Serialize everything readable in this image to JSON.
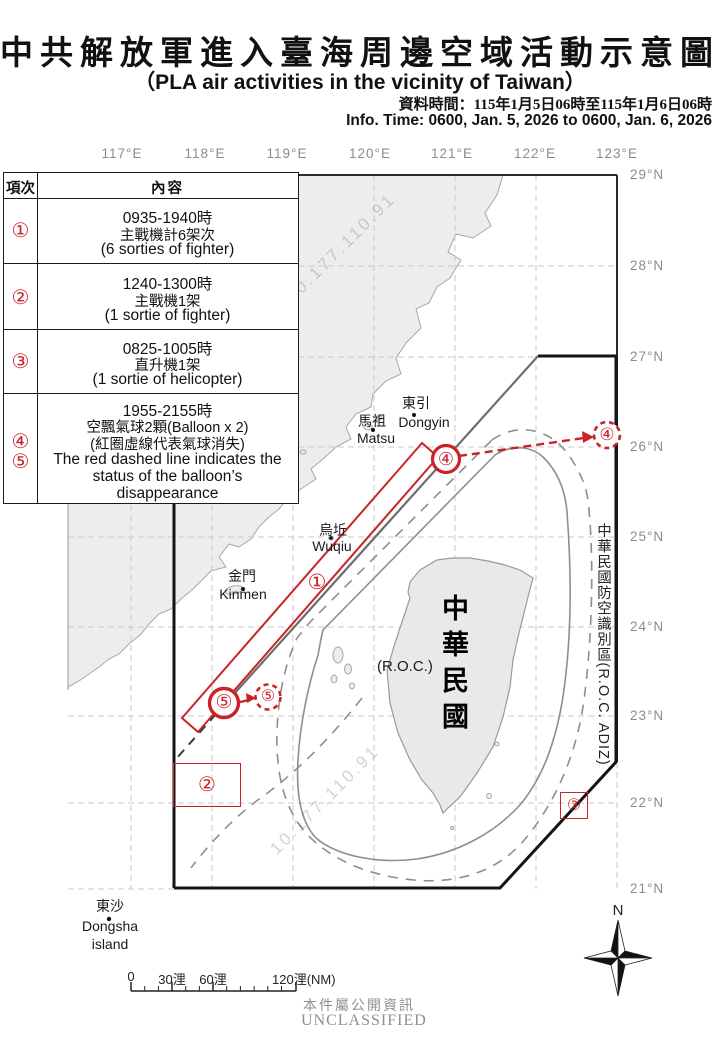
{
  "header": {
    "title_zh": "中共解放軍進入臺海周邊空域活動示意圖",
    "title_en": "（PLA air activities in the vicinity of Taiwan）",
    "info_time_zh": "資料時間：115年1月5日06時至115年1月6日06時",
    "info_time_en": "Info. Time: 0600, Jan. 5, 2026 to 0600, Jan. 6, 2026"
  },
  "table": {
    "col_item": "項次",
    "col_content": "內容",
    "rows": [
      {
        "num": "①",
        "lines": [
          "0935-1940時",
          "主戰機計6架次",
          "(6 sorties of fighter)"
        ]
      },
      {
        "num": "②",
        "lines": [
          "1240-1300時",
          "主戰機1架",
          "(1 sortie of fighter)"
        ]
      },
      {
        "num": "③",
        "lines": [
          "0825-1005時",
          "直升機1架",
          "(1 sortie of helicopter)"
        ]
      },
      {
        "num": "④",
        "num2": "⑤",
        "lines": [
          "1955-2155時",
          "空飄氣球2顆(Balloon x 2)",
          "(紅圈虛線代表氣球消失)",
          "The red dashed line indicates the",
          "status of the balloon’s",
          "disappearance"
        ]
      }
    ]
  },
  "map": {
    "lon_labels": [
      "117°E",
      "118°E",
      "119°E",
      "120°E",
      "121°E",
      "122°E",
      "123°E"
    ],
    "lat_labels": [
      "29°N",
      "28°N",
      "27°N",
      "26°N",
      "25°N",
      "24°N",
      "23°N",
      "22°N",
      "21°N"
    ],
    "places": {
      "dongyin_zh": "東引",
      "dongyin_en": "Dongyin",
      "matsu_zh": "馬祖",
      "matsu_en": "Matsu",
      "wuqiu_zh": "烏坵",
      "wuqiu_en": "Wuqiu",
      "kinmen_zh": "金門",
      "kinmen_en": "Kinmen",
      "dongsha_zh": "東沙",
      "dongsha_en1": "Dongsha",
      "dongsha_en2": "island"
    },
    "roc_zh": "中華民國",
    "roc_en": "(R.O.C.)",
    "adiz_label": "中華民國防空識別區(R.O.C. ADIZ)",
    "markers": {
      "m1": "①",
      "m2": "②",
      "m3": "③",
      "m4": "④",
      "m5": "⑤"
    },
    "watermark": "10.177.110.91"
  },
  "scalebar": {
    "l0": "0",
    "l30": "30浬",
    "l60": "60浬",
    "l120": "120浬(NM)"
  },
  "compass": {
    "north": "N"
  },
  "footer": {
    "public_zh": "本件屬公開資訊",
    "classification": "UNCLASSIFIED"
  },
  "colors": {
    "red": "#c9232a",
    "adiz_line": "#141414",
    "land": "#ededed",
    "grid": "#c9c9c9",
    "contour": "#8e8e8e"
  }
}
